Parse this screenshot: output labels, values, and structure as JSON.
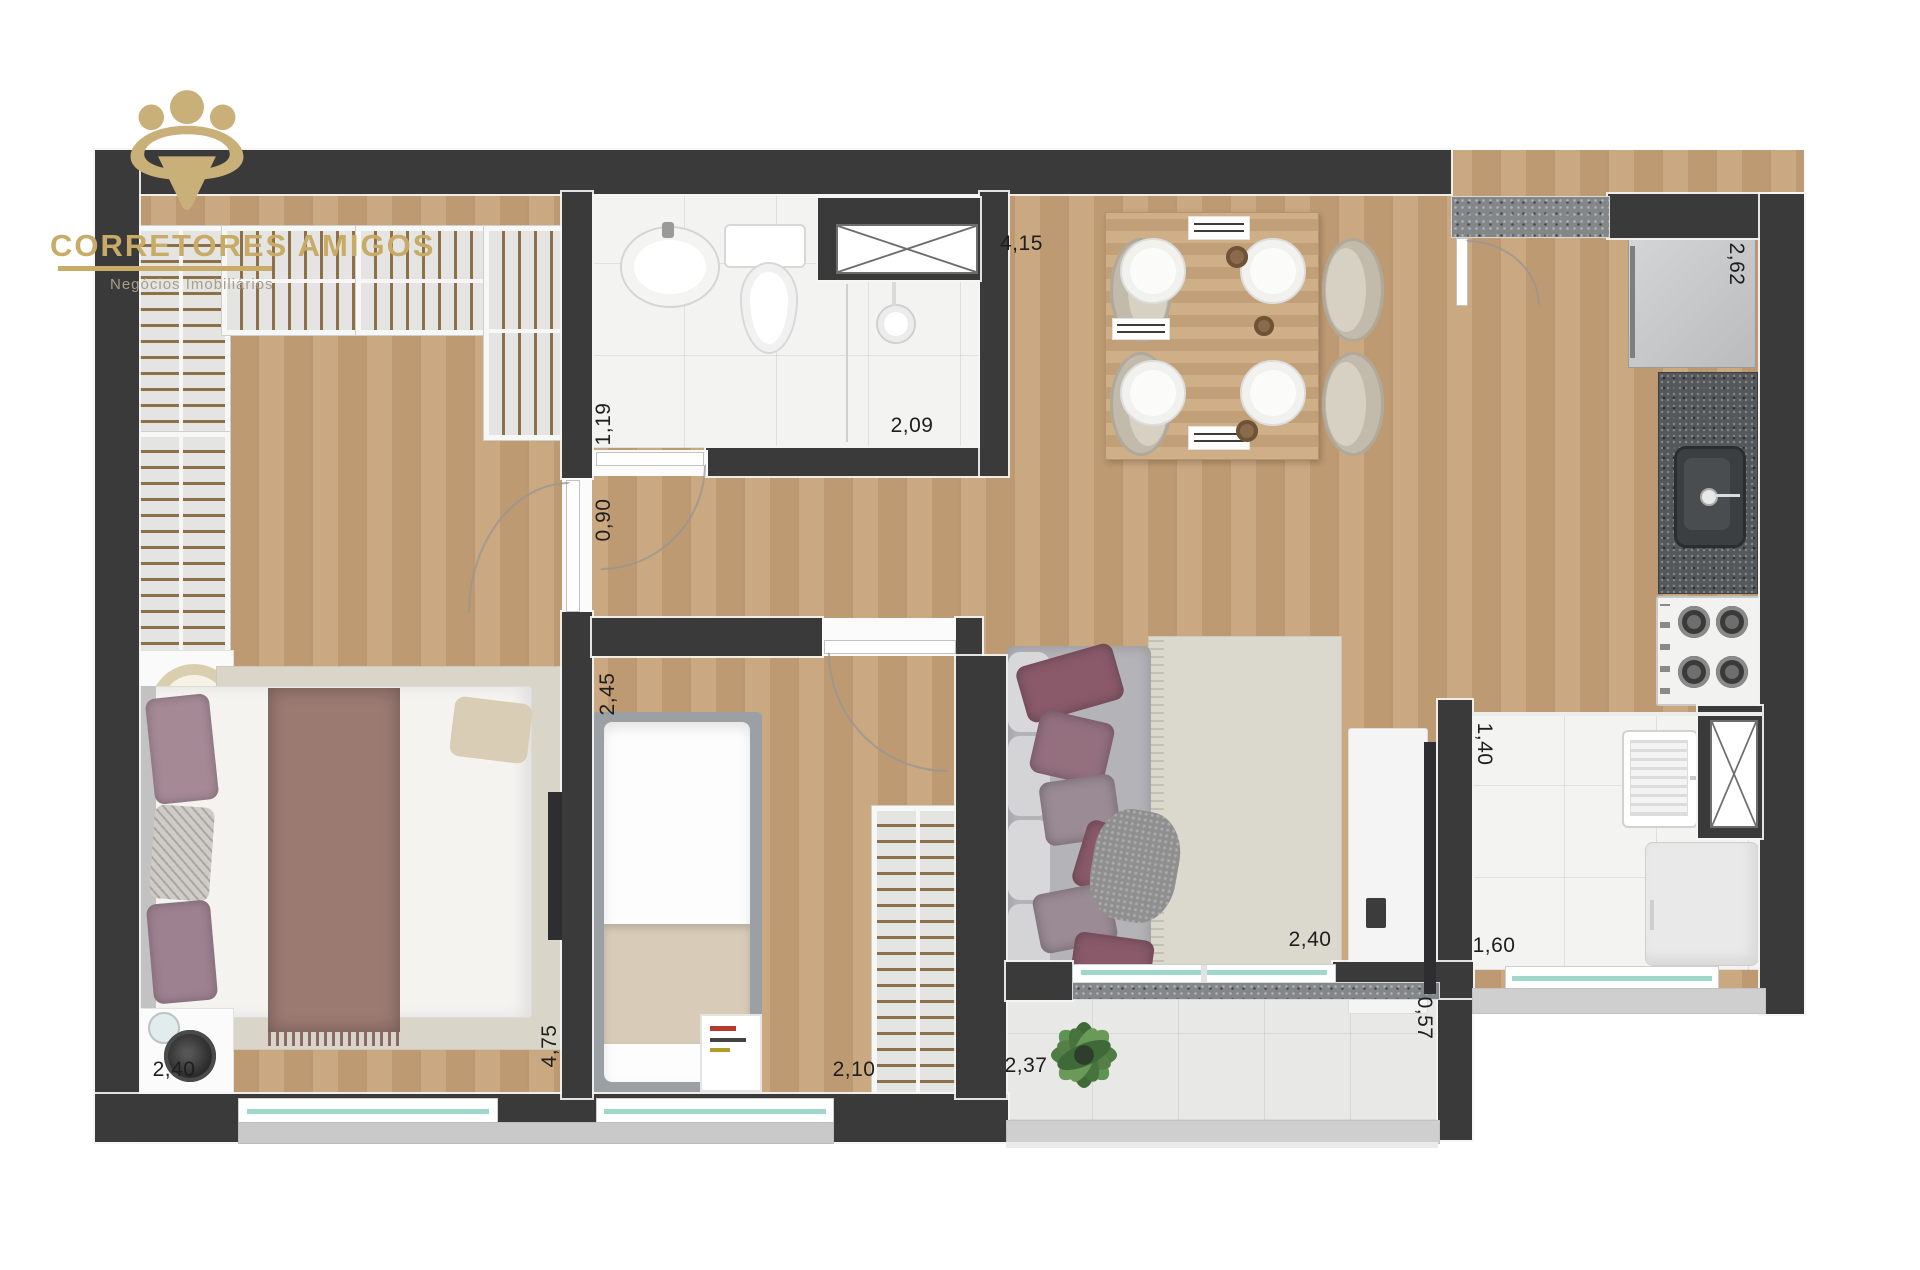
{
  "brand": {
    "name": "CORRETORES AMIGOS",
    "tagline": "Negócios Imobiliários"
  },
  "labels": {
    "living_width": "4,15",
    "kitchen_run": "2,62",
    "bath_width": "1,19",
    "bath_length": "2,09",
    "hall_width": "0,90",
    "bed2_width": "2,45",
    "bed1_width": "2,40",
    "bed1_length": "4,75",
    "bed2_length": "2,10",
    "balcony_width": "2,37",
    "living_length": "2,40",
    "service_width": "1,40",
    "service_length": "1,60",
    "service_depth": "0,57"
  },
  "colors": {
    "wall": "#3a3a3b",
    "wood_floor": "#c6a177",
    "gold_brand": "#c8ab66",
    "tile": "#f3f3f2",
    "counter_granite": "#55585a",
    "glass": "#9fd8cb"
  }
}
